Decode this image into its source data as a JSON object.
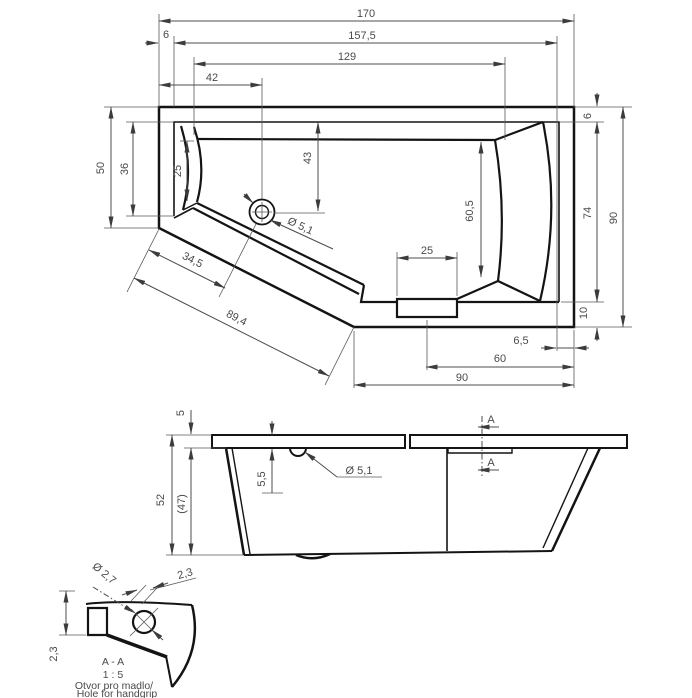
{
  "drawing": {
    "plan": {
      "len_overall": "170",
      "len_157_5": "157,5",
      "rim_left": "6",
      "len_129": "129",
      "len_42": "42",
      "width_left_outer": "50",
      "width_left_inner": "36",
      "seat_25": "25",
      "drain_offset_43": "43",
      "width_60_5": "60,5",
      "drain_dia": "Ø 5,1",
      "diag_34_5": "34,5",
      "diag_89_4": "89,4",
      "rim_right": "6",
      "height_74": "74",
      "height_90": "90",
      "bottom_10": "10",
      "grip_25": "25",
      "bottom_6_5": "6,5",
      "bottom_60": "60",
      "bottom_90": "90"
    },
    "side": {
      "rim_5": "5",
      "height_52": "52",
      "height_47": "(47)",
      "hole_depth_5_5": "5,5",
      "hole_dia": "Ø 5,1",
      "section_a_top": "A",
      "section_a_bottom": "A"
    },
    "detail": {
      "hole_dia_2_7": "Ø 2,7",
      "thk_top_2_3": "2,3",
      "thk_left_2_3": "2,3",
      "section_label": "A - A",
      "scale_label": "1 : 5",
      "note_cz": "Otvor pro madlo/",
      "note_en": "Hole for handgrip"
    }
  }
}
